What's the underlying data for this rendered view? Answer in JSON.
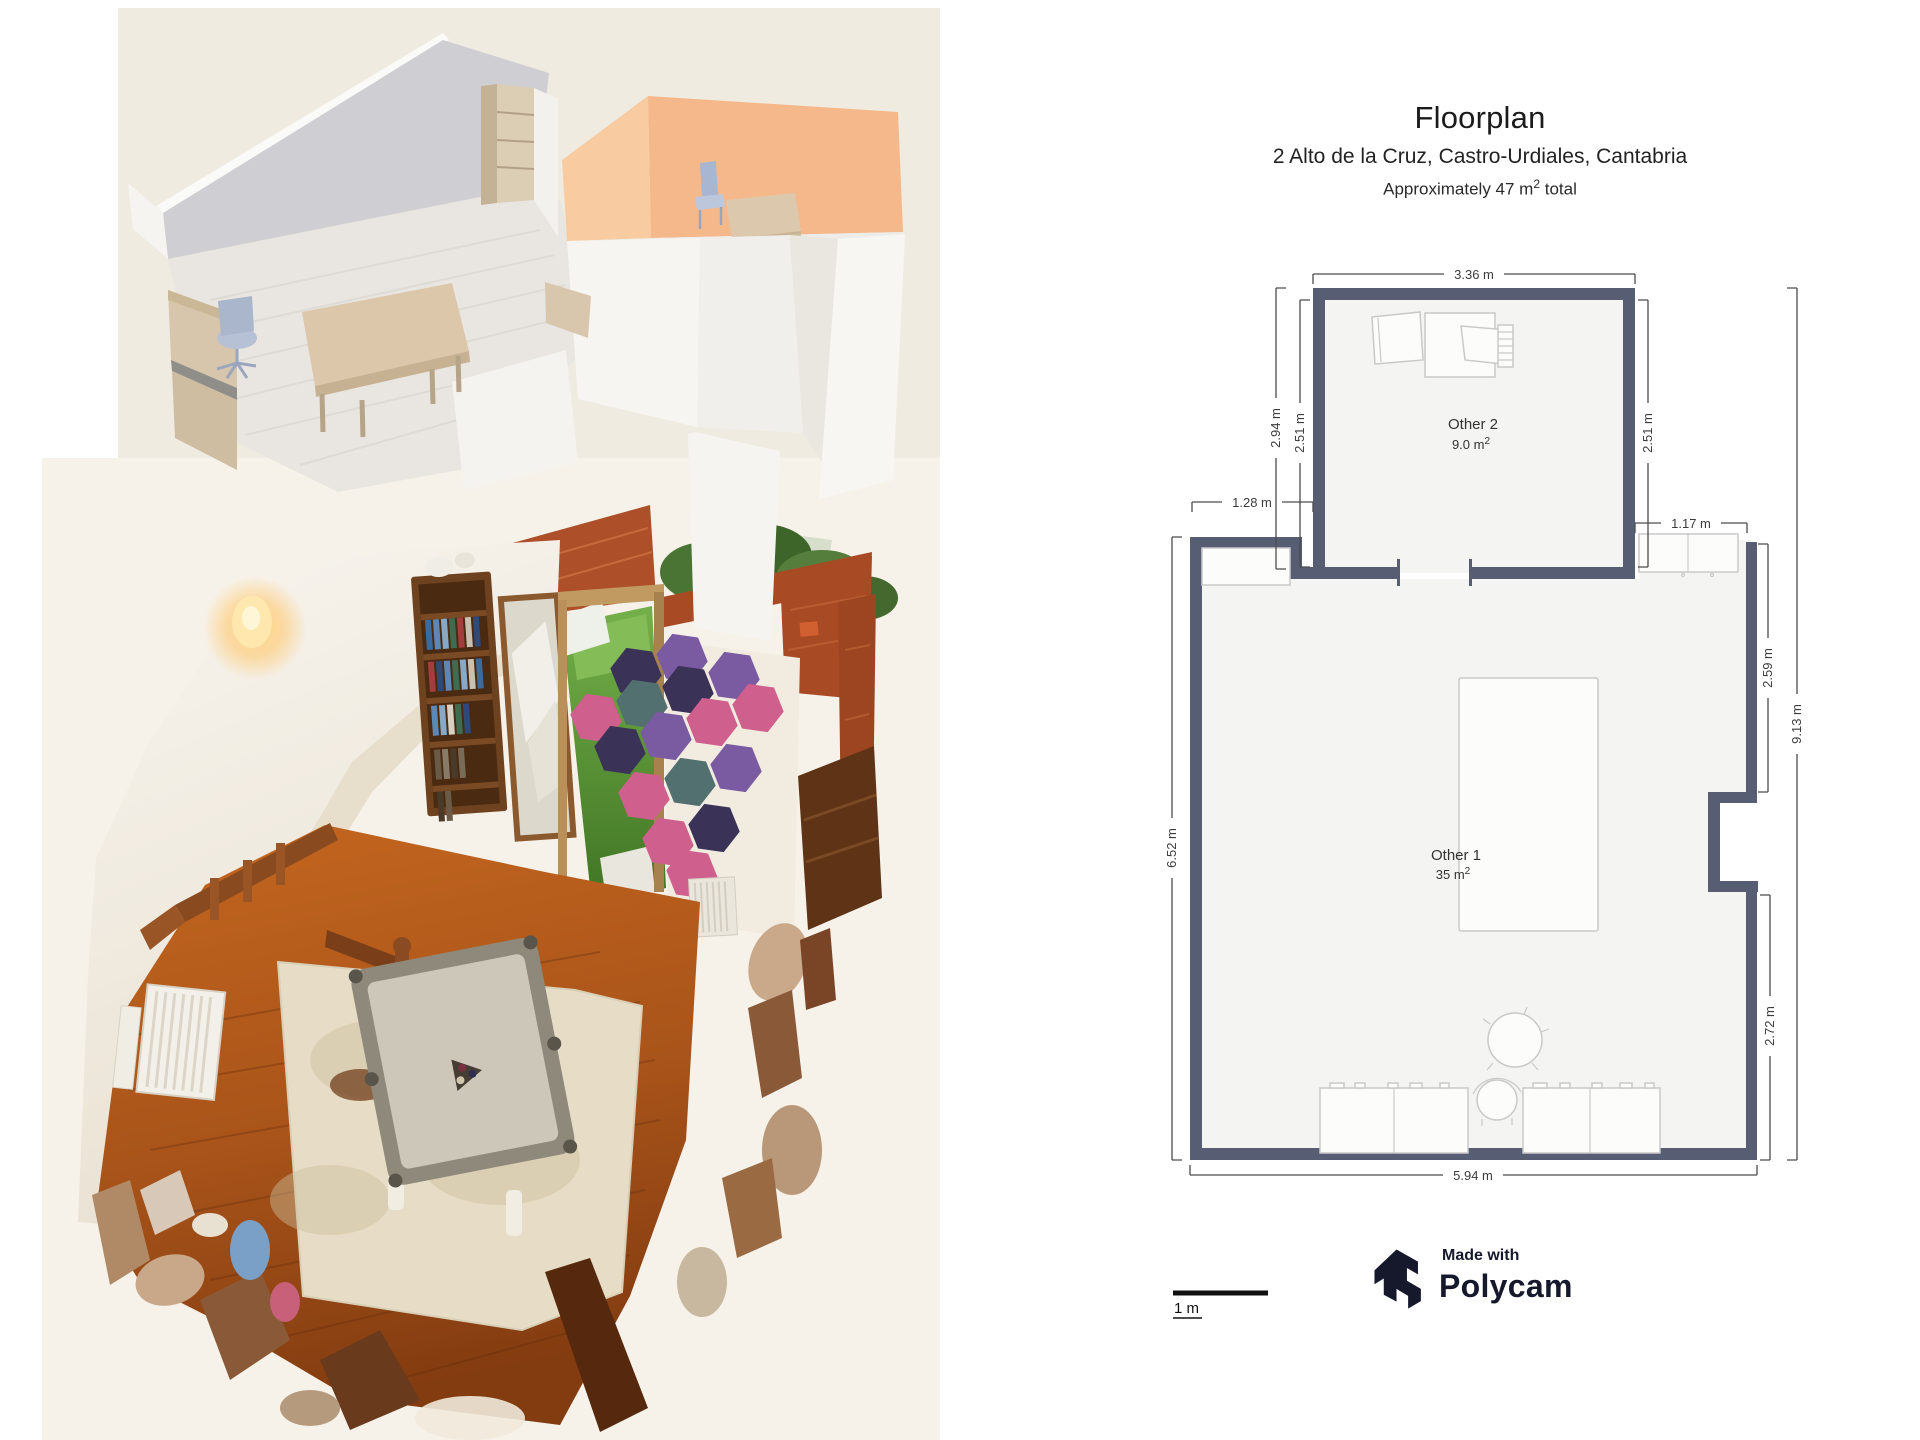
{
  "floorplan": {
    "title": "Floorplan",
    "subtitle": "2 Alto de la Cruz, Castro-Urdiales, Cantabria",
    "approx": {
      "prefix": "Approximately 47 m",
      "sup": "2",
      "suffix": " total"
    },
    "rooms": {
      "other2": {
        "name": "Other 2",
        "area": "9.0 m",
        "area_sup": "2"
      },
      "other1": {
        "name": "Other 1",
        "area": "35 m",
        "area_sup": "2"
      }
    },
    "dims": {
      "top": "3.36 m",
      "left_outer": "2.94 m",
      "left_inner": "2.51 m",
      "right_inner": "2.51 m",
      "step": "1.28 m",
      "cabinet": "1.17 m",
      "left_full": "6.52 m",
      "right_upper": "2.59 m",
      "right_full": "9.13 m",
      "right_lower": "2.72 m",
      "bottom": "5.94 m"
    },
    "scale_label": "1 m",
    "credit": {
      "made_with": "Made with",
      "brand": "Polycam"
    },
    "colors": {
      "wall": "#575d73",
      "dimension_text": "#3c3c3c",
      "furniture_outline": "#c9c9c9",
      "room_fill": "#f4f4f2",
      "brand_navy": "#16182c",
      "model_orange_wall": "#f5b88b",
      "scan_floor_wood": "#a9541a",
      "hex_pink": "#cf5f8d",
      "hex_dark": "#3b3357",
      "hex_violet": "#7a5aa0",
      "hex_teal": "#527070"
    }
  }
}
